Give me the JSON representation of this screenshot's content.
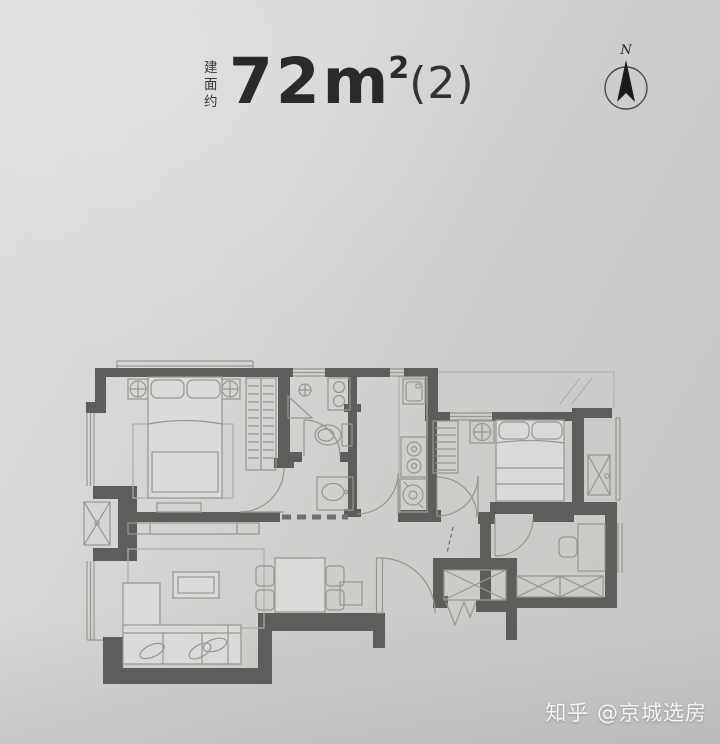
{
  "theme": {
    "paper-light": "#dcdedd",
    "paper-dark": "#c6c6c4",
    "wall": "#5d5d5b",
    "line": "#97978f",
    "line-light": "#aeaeac",
    "ink": "#2a2a2a",
    "wm": "#f4f4f2"
  },
  "header": {
    "prefix_vertical": "建面约",
    "area_number": "72",
    "unit": "m",
    "sup": "2",
    "suffix": "(2)"
  },
  "compass": {
    "label": "N"
  },
  "watermark": {
    "text": "知乎 @京城选房"
  },
  "floorplan": {
    "elements": [
      "master-bedroom",
      "second-bedroom",
      "living-room",
      "dining-area",
      "kitchen",
      "bathroom",
      "entry-hall",
      "study",
      "elevator-shaft",
      "ac-platform-west",
      "ac-platform-east",
      "bay-window-bedroom",
      "bay-window-living",
      "north-window",
      "double-bed",
      "single-bed",
      "wardrobe",
      "nightstand-with-lamp",
      "l-shaped-sofa",
      "coffee-table",
      "rug",
      "tv-cabinet",
      "dining-table",
      "dining-chairs",
      "kitchen-sink",
      "gas-stove",
      "washing-machine",
      "toilet",
      "shower-corner",
      "washbasin",
      "desk",
      "storage-cabinets",
      "elevator-doors",
      "door-swings"
    ]
  }
}
